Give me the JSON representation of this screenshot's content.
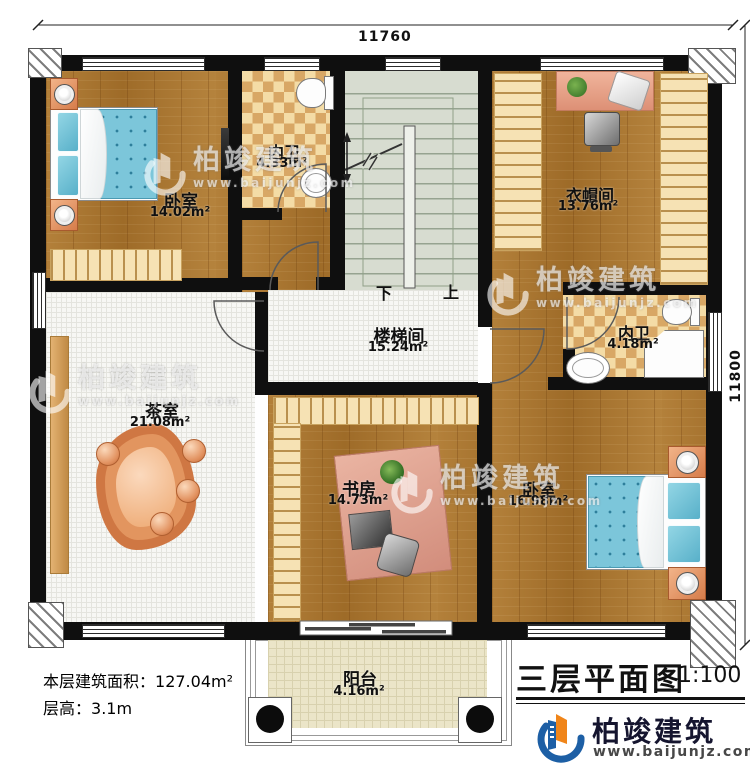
{
  "dimensions": {
    "top": "11760",
    "right": "11800"
  },
  "rooms": [
    {
      "id": "bedroom1",
      "name": "卧室",
      "area": "14.02m²"
    },
    {
      "id": "bath1",
      "name": "内卫",
      "area": "4.33m²"
    },
    {
      "id": "stairwell",
      "name": "楼梯间",
      "area": "15.24m²"
    },
    {
      "id": "cloakroom",
      "name": "衣帽间",
      "area": "13.76m²"
    },
    {
      "id": "bath2",
      "name": "内卫",
      "area": "4.18m²"
    },
    {
      "id": "tearoom",
      "name": "茶室",
      "area": "21.08m²"
    },
    {
      "id": "study",
      "name": "书房",
      "area": "14.73m²"
    },
    {
      "id": "bedroom2",
      "name": "卧室",
      "area": "16.98m²"
    },
    {
      "id": "balcony",
      "name": "阳台",
      "area": "4.16m²"
    }
  ],
  "stairs": {
    "down": "下",
    "up": "上"
  },
  "footer": {
    "floor_area_label": "本层建筑面积：",
    "floor_area_value": "127.04m²",
    "floor_height_label": "层高：",
    "floor_height_value": "3.1m",
    "plan_title": "三层平面图",
    "plan_scale": "1:100"
  },
  "branding": {
    "company": "柏竣建筑",
    "website": "www.baijunjz.com"
  },
  "watermark": {
    "text": "柏竣建筑",
    "website": "www.baijunjz.com"
  },
  "colors": {
    "wall": "#0f0f0f",
    "wood_floor": "#a97530",
    "tile_tan": "#d8a765",
    "stair": "#d7dcd0",
    "bed_blue": "#7cc6da",
    "logo_blue": "#1d5fa5",
    "logo_orange": "#f08519"
  }
}
